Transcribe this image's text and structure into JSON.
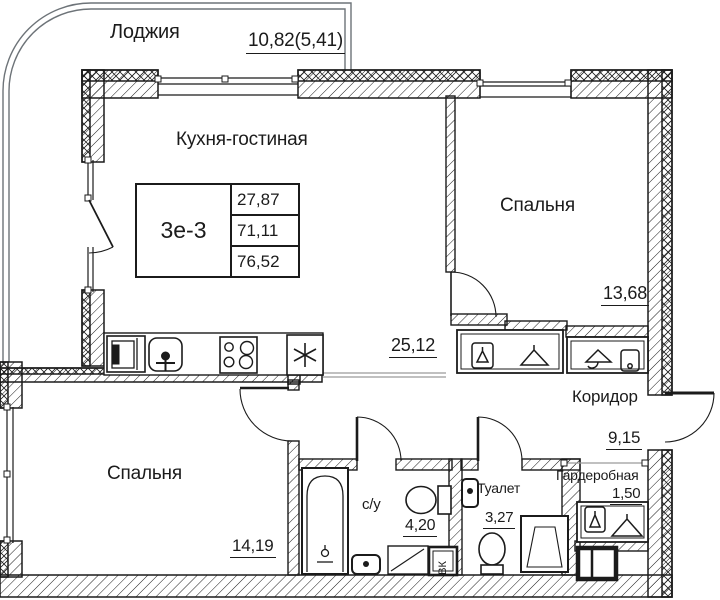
{
  "plan": {
    "unit_table": {
      "type": "3е-3",
      "rows": [
        "27,87",
        "71,11",
        "76,52"
      ]
    },
    "rooms": [
      {
        "id": "loggia",
        "label": "Лоджия",
        "area": "10,82(5,41)"
      },
      {
        "id": "kitchen-living",
        "label": "Кухня-гостиная",
        "area": "25,12"
      },
      {
        "id": "bedroom-right",
        "label": "Спальня",
        "area": "13,68"
      },
      {
        "id": "corridor",
        "label": "Коридор",
        "area": "9,15"
      },
      {
        "id": "bedroom-left",
        "label": "Спальня",
        "area": "14,19"
      },
      {
        "id": "bathroom",
        "label": "с/у",
        "area": "4,20"
      },
      {
        "id": "toilet",
        "label": "Туалет",
        "area": "3,27"
      },
      {
        "id": "wardrobe",
        "label": "Гардеробная",
        "area": "1,50"
      }
    ],
    "annotations": {
      "duct_label": "ВК"
    },
    "icons": [
      "stove-icon",
      "kitchen-sink-icon",
      "kitchen-cabinet-icon",
      "ventilation-icon",
      "bathtub-icon",
      "toilet-icon",
      "washbasin-icon",
      "shower-tray-icon",
      "washing-machine-icon",
      "hanger-icon",
      "wardrobe-box-icon",
      "electrical-panel-icon"
    ],
    "colors": {
      "line": "#1b1b1b",
      "zone_line": "#9a9a9a",
      "glazing": "#6d7378",
      "bg": "#ffffff"
    }
  }
}
